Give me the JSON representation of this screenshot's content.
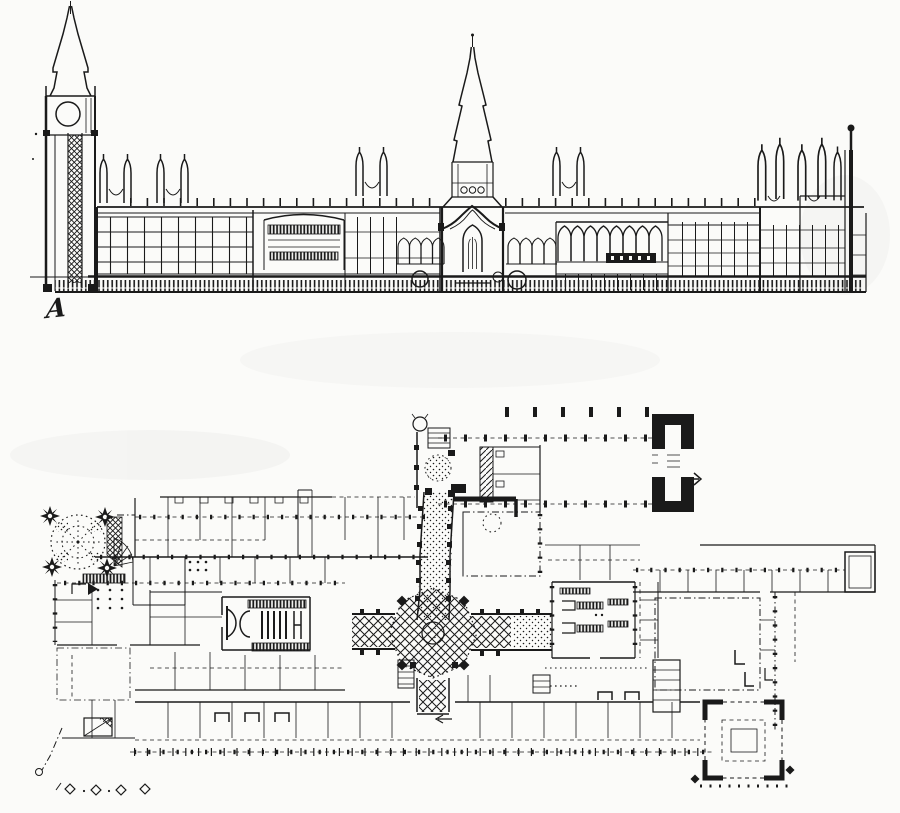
{
  "figure": {
    "annotation_label": "A"
  },
  "colors": {
    "ink": "#1a1a1a",
    "paper": "#fbfbf9"
  }
}
